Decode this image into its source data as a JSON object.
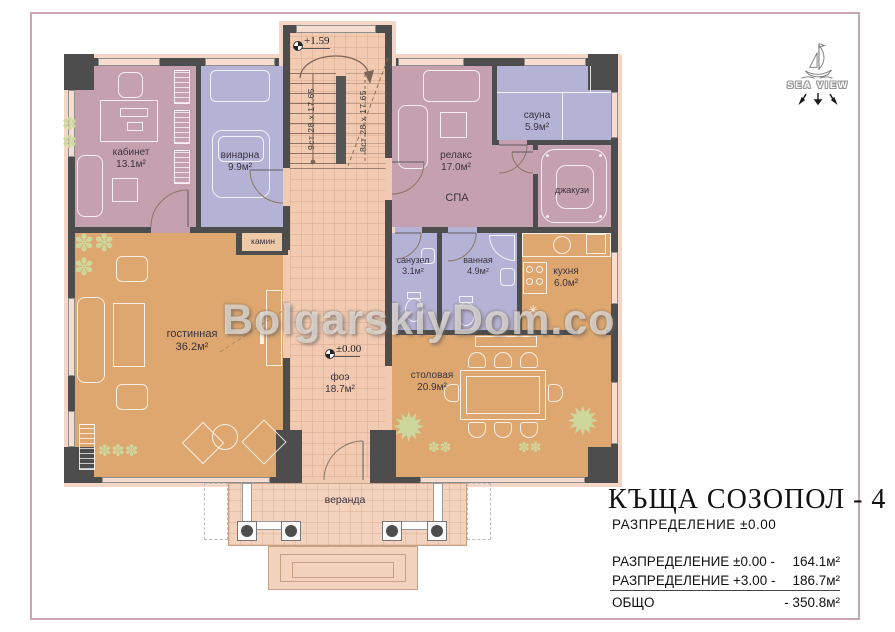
{
  "colors": {
    "wall": "#4d4d4d",
    "pink": "#c5a0ae",
    "lavender": "#b5b3d5",
    "orange": "#dda76f",
    "peach": "#f1cab1",
    "veranda": "#f3d3be",
    "plant": "#cdd79c",
    "frame": "#c9a7b3"
  },
  "watermark": "BolgarskiyDom.co",
  "logo": {
    "name": "SEA VIEW"
  },
  "levels": {
    "upper": "+1.59",
    "ground": "±0.00"
  },
  "stairs": {
    "flight_up": "9ст 28 х 17.65",
    "flight_down": "8ст 28 х 17.65"
  },
  "rooms": {
    "kabinet": {
      "name": "кабинет",
      "area": "13.1м²"
    },
    "vinarna": {
      "name": "винарна",
      "area": "9.9м²"
    },
    "relax": {
      "name": "релакс",
      "area": "17.0м²"
    },
    "spa": {
      "name": "СПА"
    },
    "sauna": {
      "name": "сауна",
      "area": "5.9м²"
    },
    "jacuzzi": {
      "name": "джакузи"
    },
    "sanuzel": {
      "name": "санузел",
      "area": "3.1м²"
    },
    "vannaya": {
      "name": "ванная",
      "area": "4.9м²"
    },
    "kuhnya": {
      "name": "кухня",
      "area": "6.0м²"
    },
    "gostinnaya": {
      "name": "гостинная",
      "area": "36.2м²"
    },
    "foyer": {
      "name": "фоэ",
      "area": "18.7м²"
    },
    "stolovaya": {
      "name": "столовая",
      "area": "20.9м²"
    },
    "kamin": {
      "name": "камин"
    },
    "veranda": {
      "name": "веранда"
    }
  },
  "icons": {
    "plant_row": "✽✽✽",
    "plant_pair": "✽✽",
    "plant_cluster": "✽✽\n✽",
    "plant_col": "✽\n✽",
    "palm": "✹",
    "star": "✳"
  },
  "title_block": {
    "title": "КЪЩА СОЗОПОЛ - 4",
    "subtitle": "РАЗПРЕДЕЛЕНИЕ ±0.00",
    "rows": [
      {
        "label": "РАЗПРЕДЕЛЕНИЕ ±0.00 -",
        "value": "164.1м²"
      },
      {
        "label": "РАЗПРЕДЕЛЕНИЕ +3.00 -",
        "value": "186.7м²"
      }
    ],
    "total_label": "ОБЩО",
    "total_value": "- 350.8м²"
  }
}
